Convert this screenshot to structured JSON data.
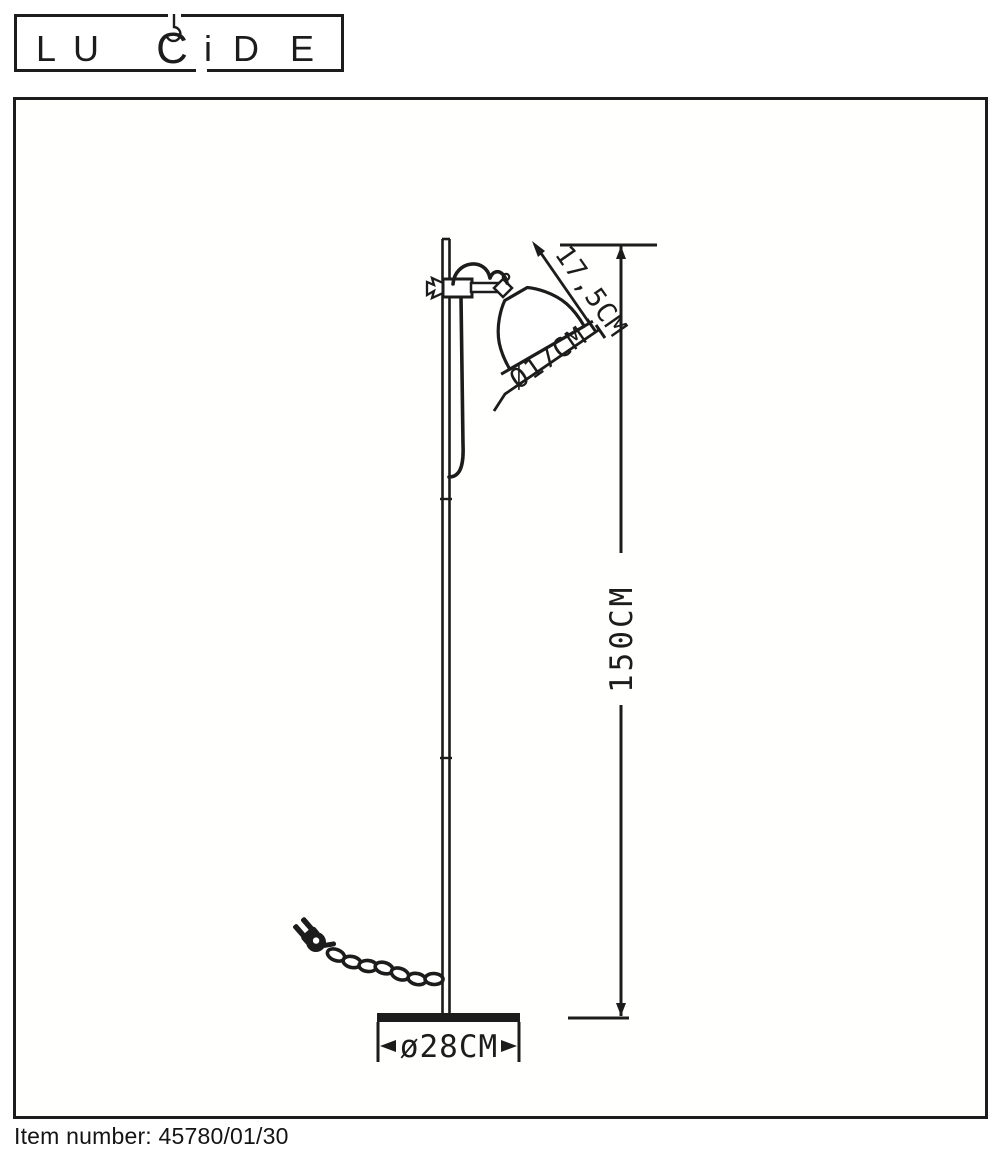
{
  "logo": {
    "name": "LUCIDE",
    "letters": [
      "L",
      "U",
      "C",
      "i",
      "D",
      "E"
    ]
  },
  "drawing": {
    "dimensions": {
      "shade_length": "17,5CM",
      "shade_diameter": "Ø17CM",
      "lamp_height": "150CM",
      "base_diameter": "ø28CM"
    }
  },
  "footer": {
    "label": "Item number:",
    "value": "45780/01/30"
  },
  "colors": {
    "ink": "#1c1c1c",
    "background": "#ffffff"
  }
}
